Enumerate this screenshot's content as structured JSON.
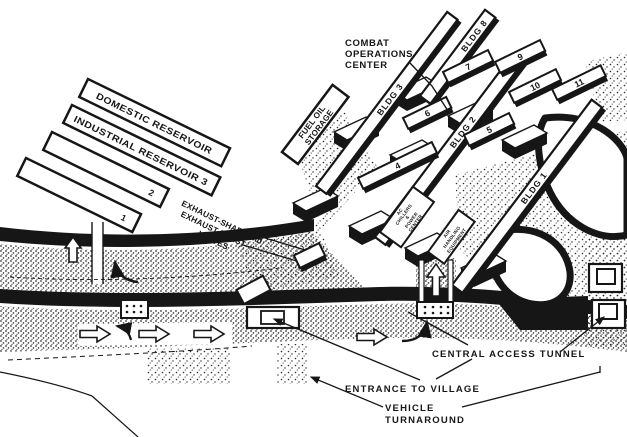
{
  "diagram": {
    "reservoirs": {
      "domestic": "DOMESTIC RESERVOIR",
      "industrial": "INDUSTRIAL RESERVOIR 3",
      "unit2": "2",
      "unit1": "1"
    },
    "fuel_oil": {
      "line1": "FUEL OIL",
      "line2": "STORAGE"
    },
    "exhaust_label": {
      "line1": "EXHAUST-SHAFT and",
      "line2": "EXHAUST-BLAST",
      "line3": "VALVES"
    },
    "combat_operations_center": {
      "line1": "COMBAT",
      "line2": "OPERATIONS",
      "line3": "CENTER"
    },
    "buildings": {
      "bldg1": "BLDG 1",
      "bldg2": "BLDG 2",
      "bldg3": "BLDG 3",
      "bldg8": "BLDG 8",
      "unit4": "4",
      "unit5": "5",
      "unit6": "6",
      "unit7": "7",
      "unit9": "9",
      "unit10": "10",
      "unit11": "11"
    },
    "plant": {
      "chillers": {
        "l1": "AC",
        "l2": "CHILLERS",
        "l3": "&",
        "l4": "POWER",
        "l5": "CENTER"
      },
      "air_handling": {
        "l1": "AIR",
        "l2": "HANDLING",
        "l3": "EQUIPMENT"
      }
    },
    "access": {
      "central": "CENTRAL ACCESS TUNNEL",
      "entrance": "ENTRANCE TO VILLAGE",
      "turnaround1": "VEHICLE",
      "turnaround2": "TURNAROUND"
    },
    "colors": {
      "ink": "#161616",
      "paper": "#ffffff"
    }
  }
}
